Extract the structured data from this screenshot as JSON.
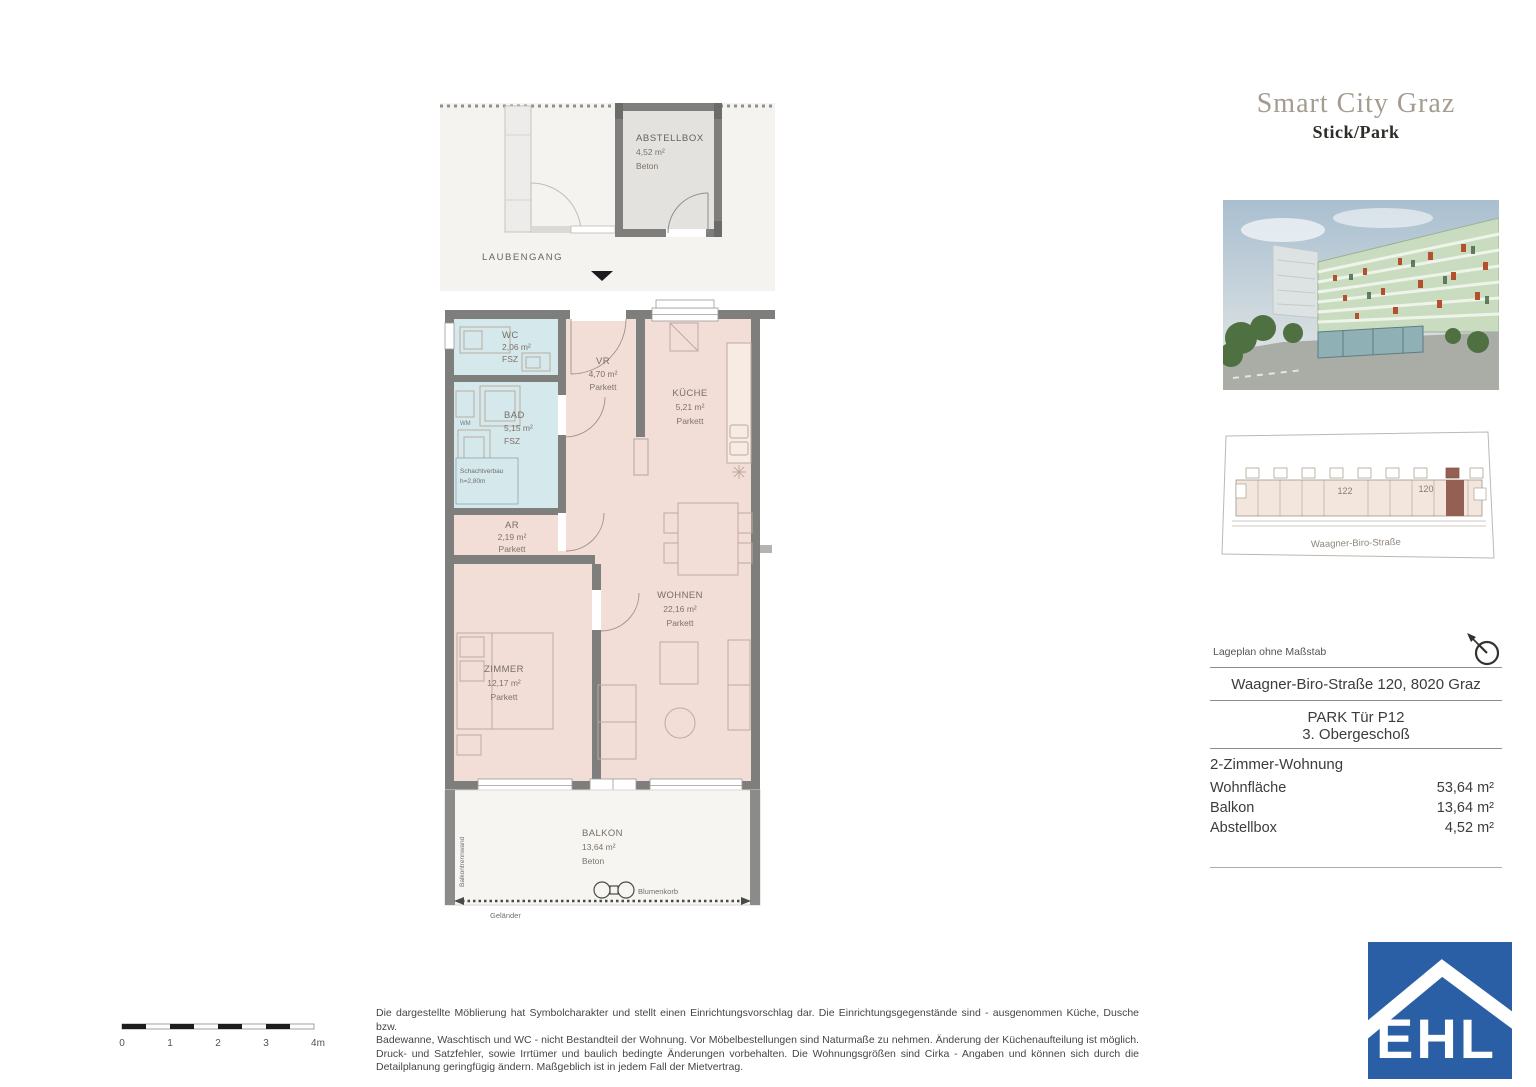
{
  "header": {
    "project": "Smart City Graz",
    "subtitle": "Stick/Park"
  },
  "plan": {
    "rooms": [
      {
        "id": "abstellbox",
        "name": "ABSTELLBOX",
        "area": "4,52 m²",
        "floor": "Beton"
      },
      {
        "id": "wc",
        "name": "WC",
        "area": "2,06 m²",
        "floor": "FSZ"
      },
      {
        "id": "bad",
        "name": "BAD",
        "area": "5,15 m²",
        "floor": "FSZ"
      },
      {
        "id": "vr",
        "name": "VR",
        "area": "4,70 m²",
        "floor": "Parkett"
      },
      {
        "id": "kueche",
        "name": "KÜCHE",
        "area": "5,21 m²",
        "floor": "Parkett"
      },
      {
        "id": "ar",
        "name": "AR",
        "area": "2,19 m²",
        "floor": "Parkett"
      },
      {
        "id": "zimmer",
        "name": "ZIMMER",
        "area": "12,17 m²",
        "floor": "Parkett"
      },
      {
        "id": "wohnen",
        "name": "WOHNEN",
        "area": "22,16 m²",
        "floor": "Parkett"
      },
      {
        "id": "balkon",
        "name": "BALKON",
        "area": "13,64 m²",
        "floor": "Beton"
      }
    ],
    "labels": {
      "laubengang": "LAUBENGANG",
      "wm": "WM",
      "note_line1": "Schachtverbau",
      "note_line2": "h=2,80m",
      "blumenkorb": "Blumenkorb",
      "gelaender": "Geländer",
      "trennwand": "Balkontrennwand"
    }
  },
  "siteplan": {
    "unit_numbers": [
      "122",
      "120"
    ],
    "street": "Waagner-Biro-Straße",
    "note": "Lageplan ohne Maßstab"
  },
  "info": {
    "address": "Waagner-Biro-Straße 120, 8020 Graz",
    "unit": "PARK Tür P12",
    "floor": "3. Obergeschoß",
    "type": "2-Zimmer-Wohnung",
    "metrics": [
      {
        "label": "Wohnfläche",
        "value": "53,64 m²"
      },
      {
        "label": "Balkon",
        "value": "13,64 m²"
      },
      {
        "label": "Abstellbox",
        "value": "4,52 m²"
      }
    ]
  },
  "scale": {
    "ticks": [
      "0",
      "1",
      "2",
      "3",
      "4m"
    ]
  },
  "disclaimer": [
    "Die dargestellte Möblierung hat Symbolcharakter und stellt einen Einrichtungsvorschlag dar. Die Einrichtungsgegenstände sind - ausgenommen Küche, Dusche bzw.",
    "Badewanne, Waschtisch und WC - nicht Bestandteil der Wohnung. Vor Möbelbestellungen sind Naturmaße zu nehmen. Änderung der Küchenaufteilung ist möglich.",
    "Druck- und Satzfehler, sowie Irrtümer und baulich bedingte Änderungen vorbehalten. Die Wohnungsgrößen sind Cirka - Angaben und können sich durch die",
    "Detailplanung geringfügig ändern. Maßgeblich ist in jedem Fall der Mietvertrag."
  ],
  "logo": {
    "text": "EHL"
  },
  "colors": {
    "wall": "#7e7e7c",
    "room_pink": "#f3ded7",
    "room_blue": "#d5e8ec",
    "room_gray": "#e3e2de",
    "laubengang_bg": "#f4f3f0",
    "highlight_unit": "#946053",
    "logo_blue": "#2a5fa5"
  }
}
